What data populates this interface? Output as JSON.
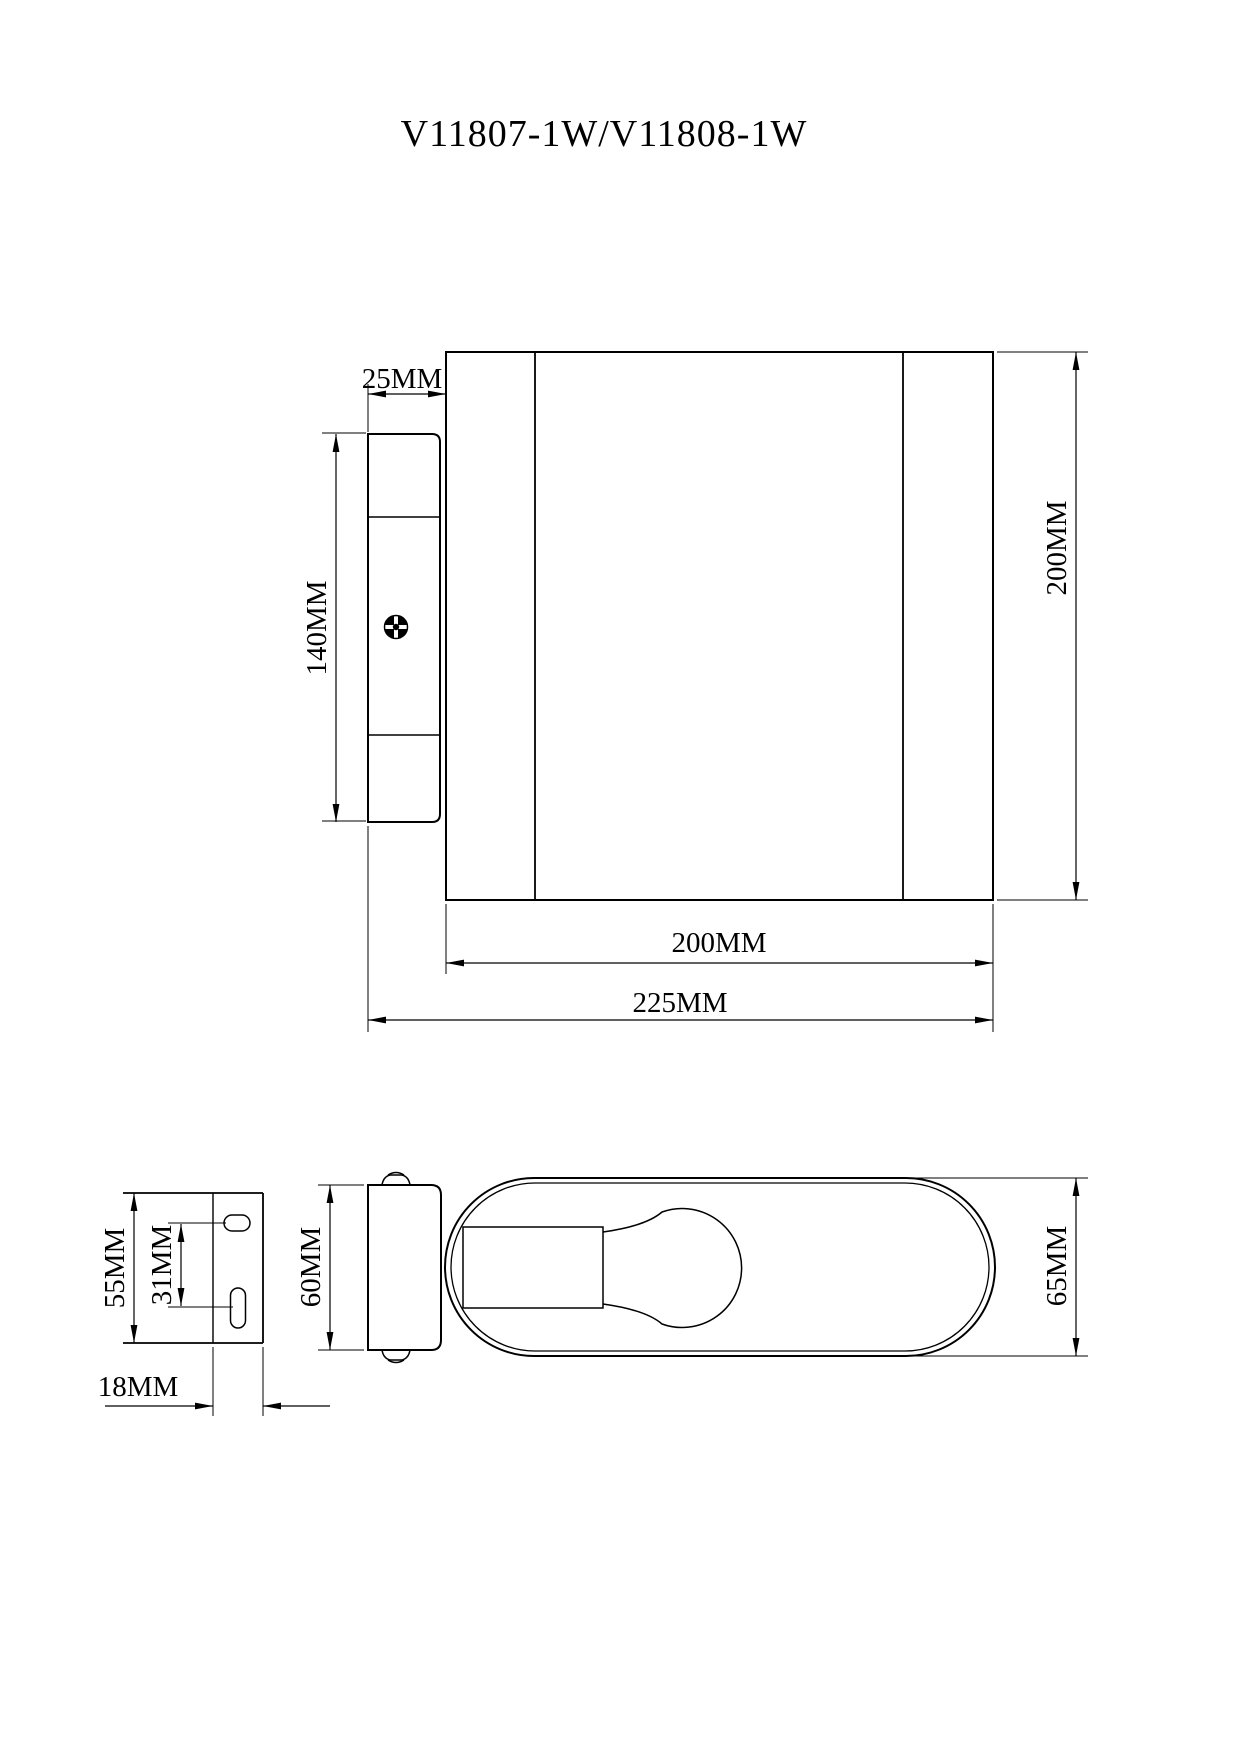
{
  "page": {
    "title": "V11807-1W/V11808-1W",
    "background_color": "#ffffff",
    "line_color": "#000000",
    "description": "Technical dimension drawing of a cylindrical wall lamp, side view with wall plate, mounting bracket view, profile view and plan view with bulb"
  },
  "labels": {
    "title": "V11807-1W/V11808-1W",
    "side_plate_depth": "25MM",
    "side_plate_height": "140MM",
    "side_height": "200MM",
    "side_width": "200MM",
    "side_total_width": "225MM",
    "bracket_height": "55MM",
    "bracket_hole_spacing": "31MM",
    "bracket_width": "18MM",
    "profile_height": "60MM",
    "plan_depth": "65MM"
  },
  "views": {
    "side_view": {
      "name": "lamp side view with wall plate and screw",
      "dimensions": [
        "25MM",
        "140MM",
        "200MM",
        "200MM",
        "225MM"
      ]
    },
    "bracket_view": {
      "name": "mounting bracket with two slotted holes",
      "dimensions": [
        "55MM",
        "31MM",
        "18MM"
      ]
    },
    "profile_view": {
      "name": "lamp body profile with set screws",
      "dimensions": [
        "60MM"
      ]
    },
    "plan_view": {
      "name": "lamp plan view with socket and bulb",
      "dimensions": [
        "65MM"
      ]
    }
  }
}
